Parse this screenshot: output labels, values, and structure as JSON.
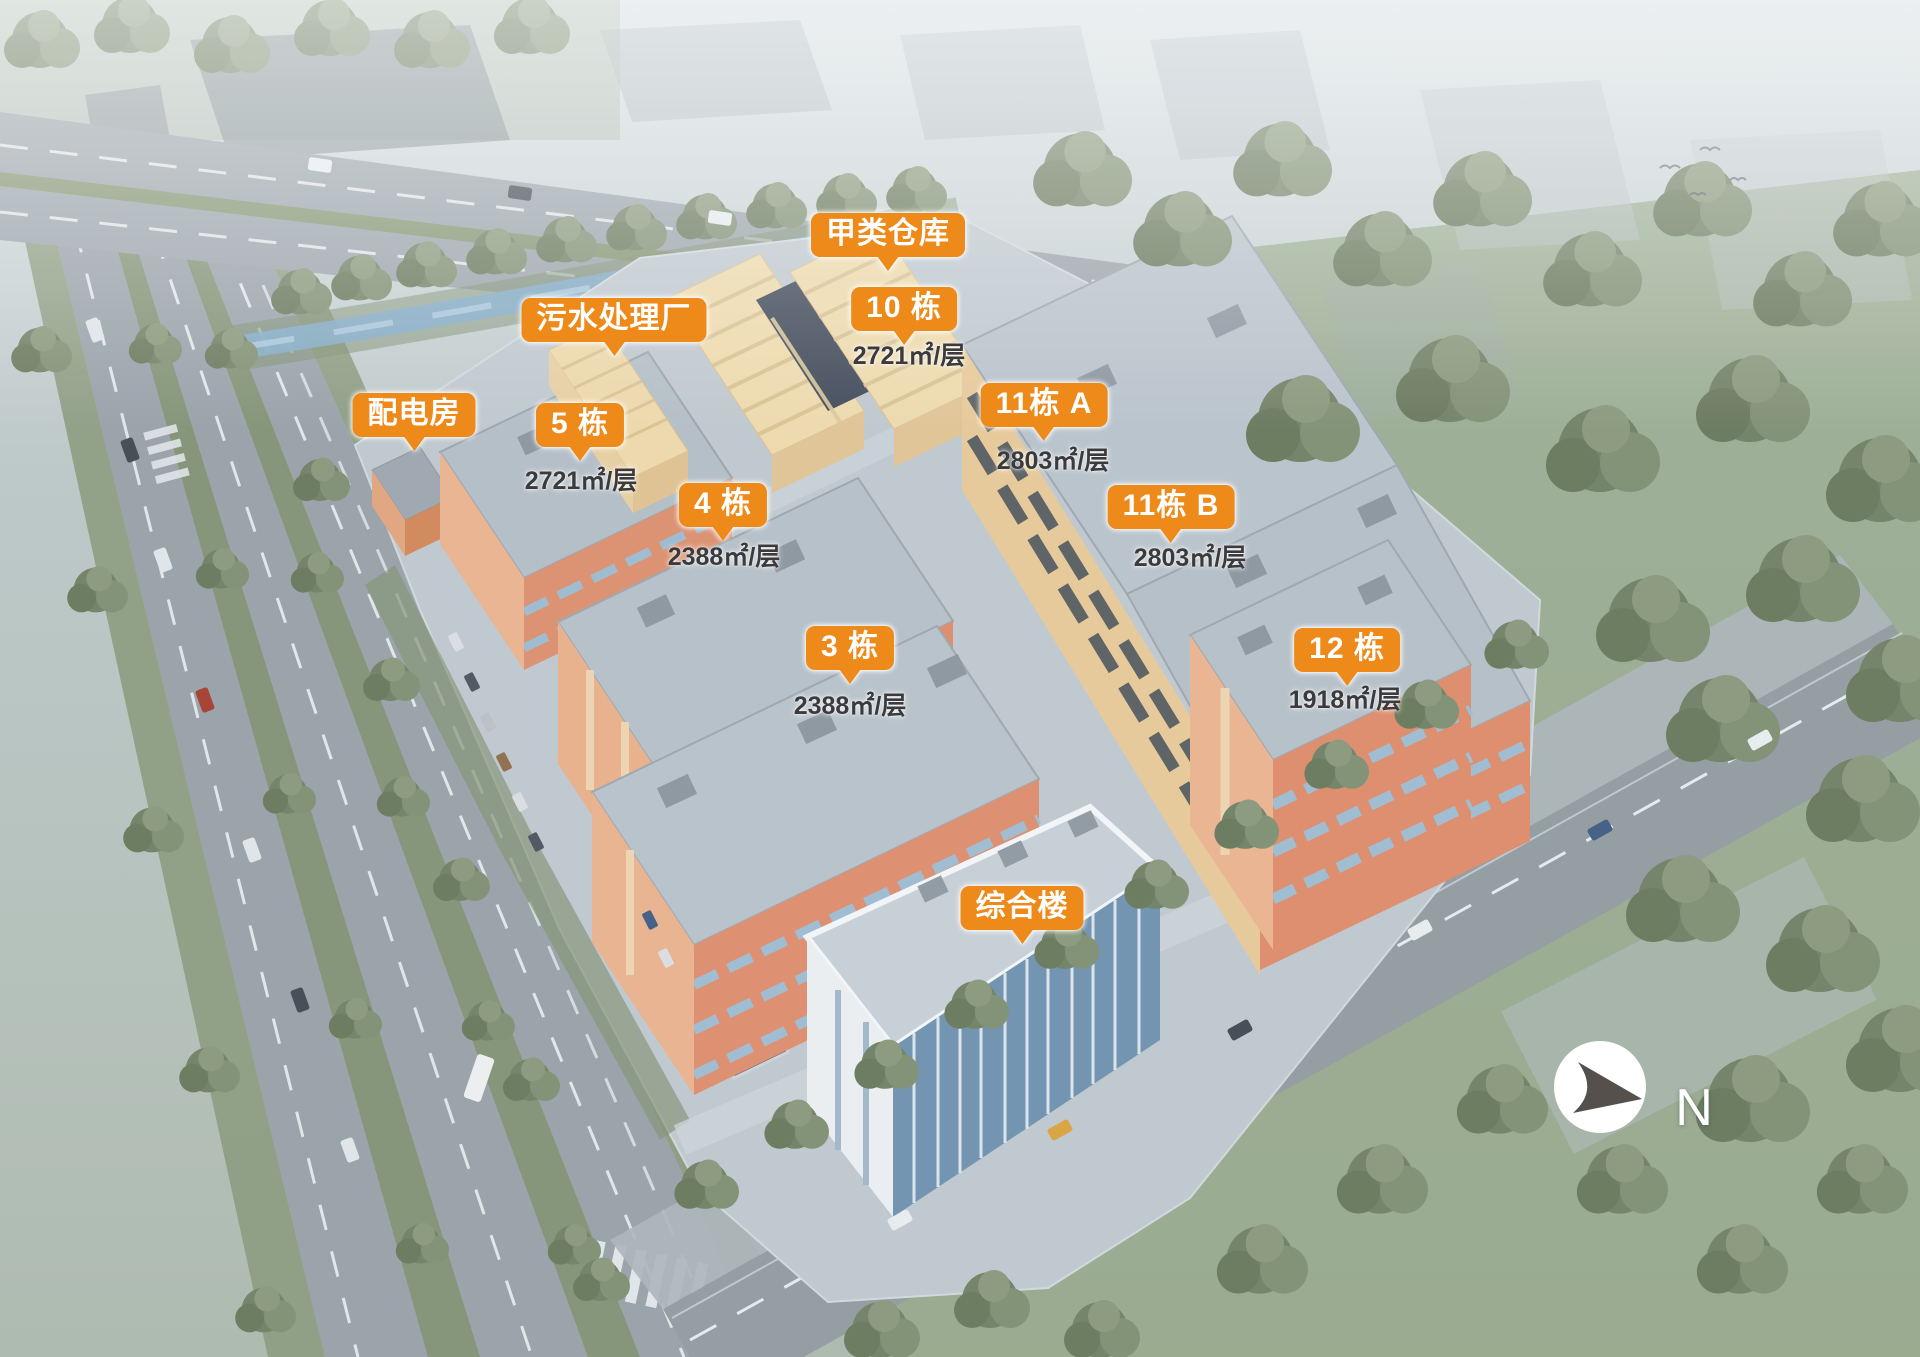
{
  "colors": {
    "accent_orange": "#EE8A1A",
    "label_text": "#FFFFFF",
    "area_text": "#3B3B3D"
  },
  "markers": [
    {
      "id": "class-a-warehouse",
      "title": "甲类仓库",
      "area": ""
    },
    {
      "id": "building-10",
      "title": "10 栋",
      "area": "2721㎡/层"
    },
    {
      "id": "sewage-plant",
      "title": "污水处理厂",
      "area": ""
    },
    {
      "id": "power-room",
      "title": "配电房",
      "area": ""
    },
    {
      "id": "building-5",
      "title": "5 栋",
      "area": "2721㎡/层"
    },
    {
      "id": "building-4",
      "title": "4 栋",
      "area": "2388㎡/层"
    },
    {
      "id": "building-11a",
      "title": "11栋 A",
      "area": "2803㎡/层"
    },
    {
      "id": "building-11b",
      "title": "11栋 B",
      "area": "2803㎡/层"
    },
    {
      "id": "building-3",
      "title": "3 栋",
      "area": "2388㎡/层"
    },
    {
      "id": "building-12",
      "title": "12 栋",
      "area": "1918㎡/层"
    },
    {
      "id": "complex-building",
      "title": "综合楼",
      "area": ""
    }
  ],
  "compass": {
    "letter": "N"
  }
}
